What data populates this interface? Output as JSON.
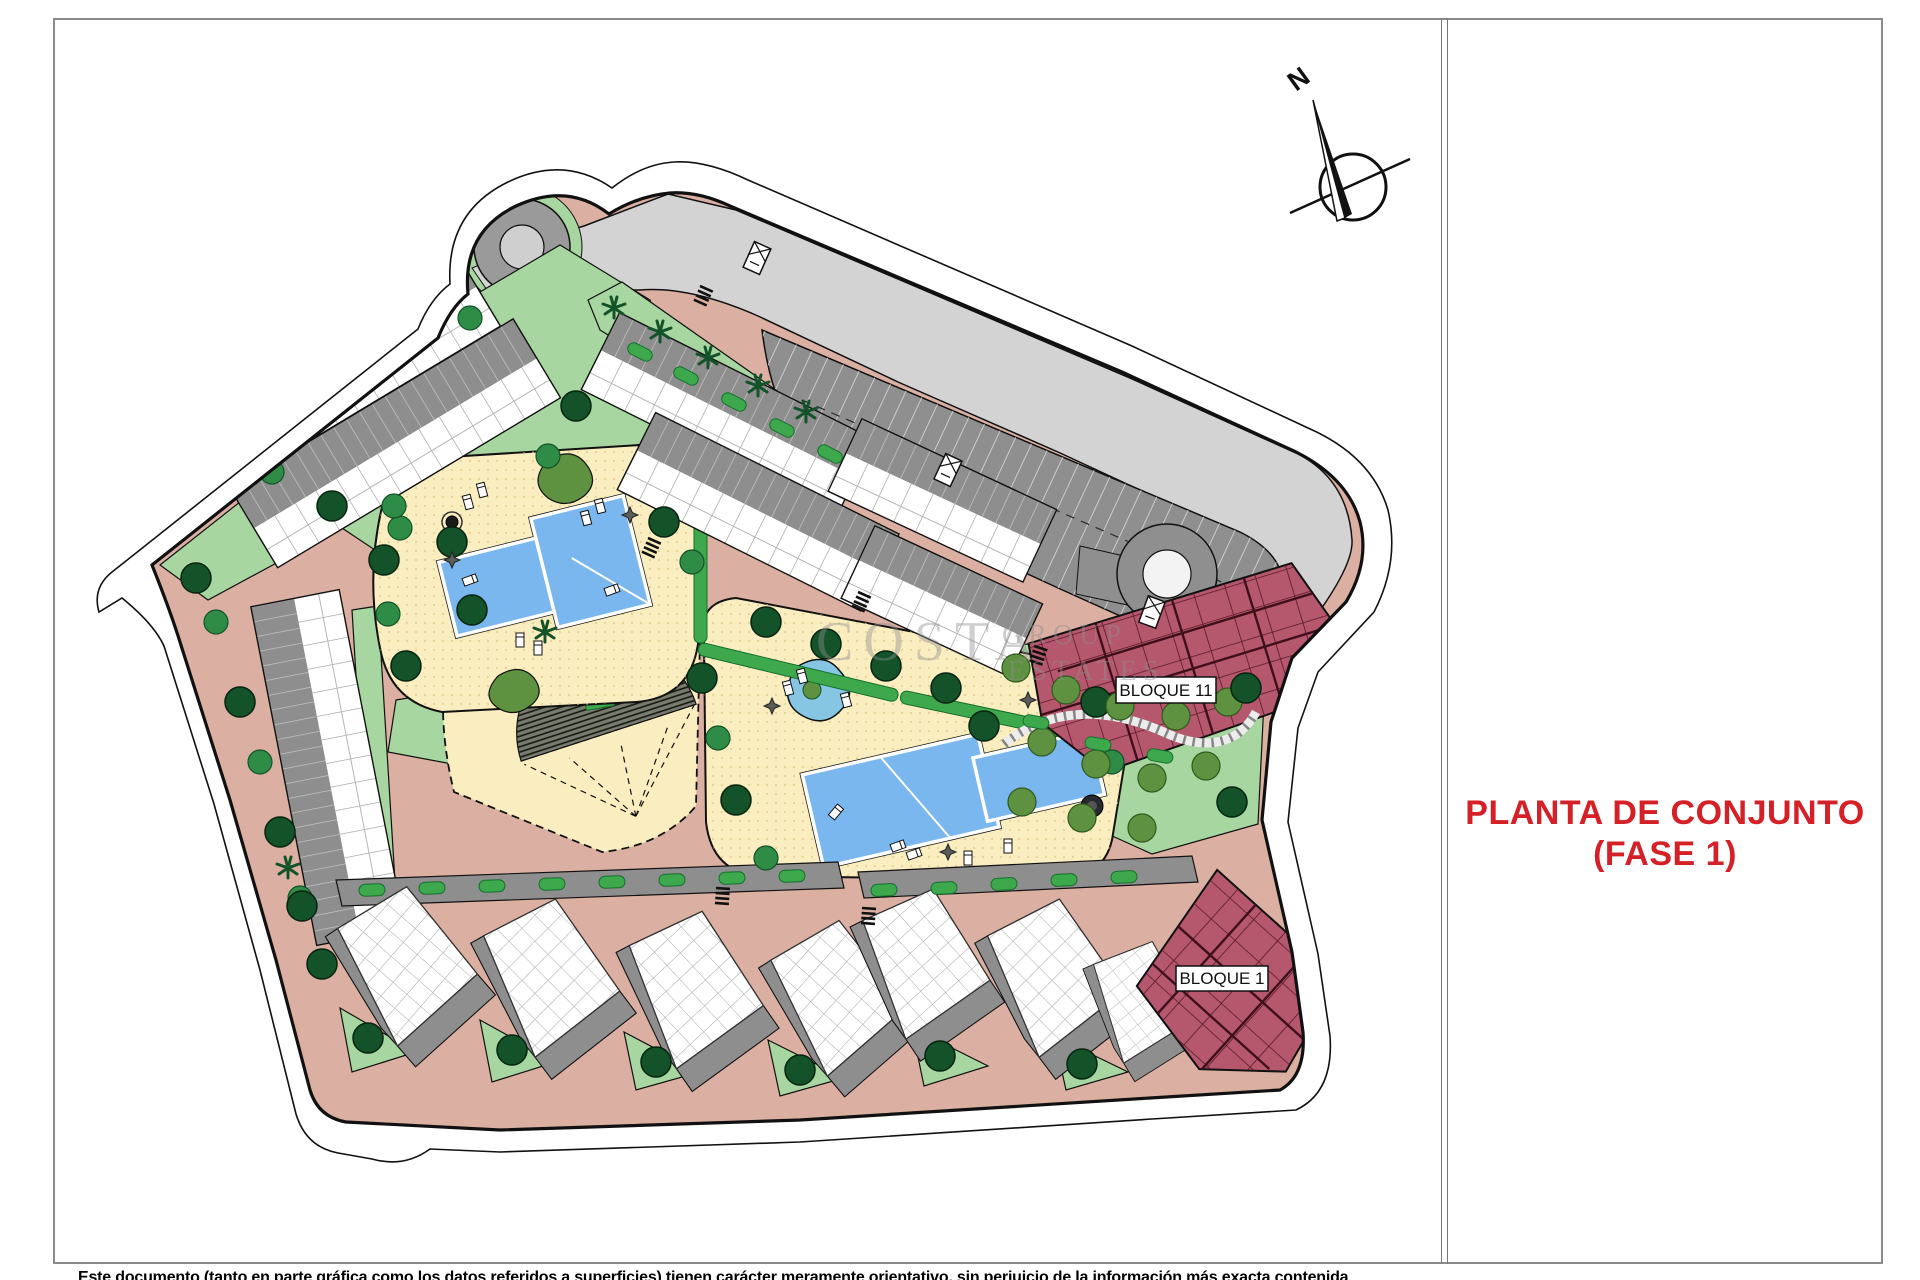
{
  "page": {
    "title_line1": "PLANTA DE CONJUNTO",
    "title_line2": "(FASE 1)",
    "compass_label": "N",
    "disclaimer": "Este documento (tanto en parte gráfica como los datos referidos a superficies) tienen carácter meramente orientativo, sin perjuicio de la información más exacta contenida"
  },
  "plan": {
    "bloque11_label": "BLOQUE 11",
    "bloque1_label": "BLOQUE 1"
  },
  "watermark": {
    "word1": "COSTA",
    "word2": "GROUP",
    "word3": "ESTATES"
  },
  "colors": {
    "road": "#dbb0a2",
    "road-gray": "#d3d3d3",
    "parking": "#8f8f8f",
    "band": "#8e8e8e",
    "green": "#a8d6a0",
    "bush": "#3ea84d",
    "tree-dark": "#14532a",
    "tree-olive": "#5e9140",
    "deck": "#faeec0",
    "pool": "#79b7ee",
    "maroon": "#b5576d",
    "title-red": "#d42026",
    "frame": "#8a8a8a"
  }
}
